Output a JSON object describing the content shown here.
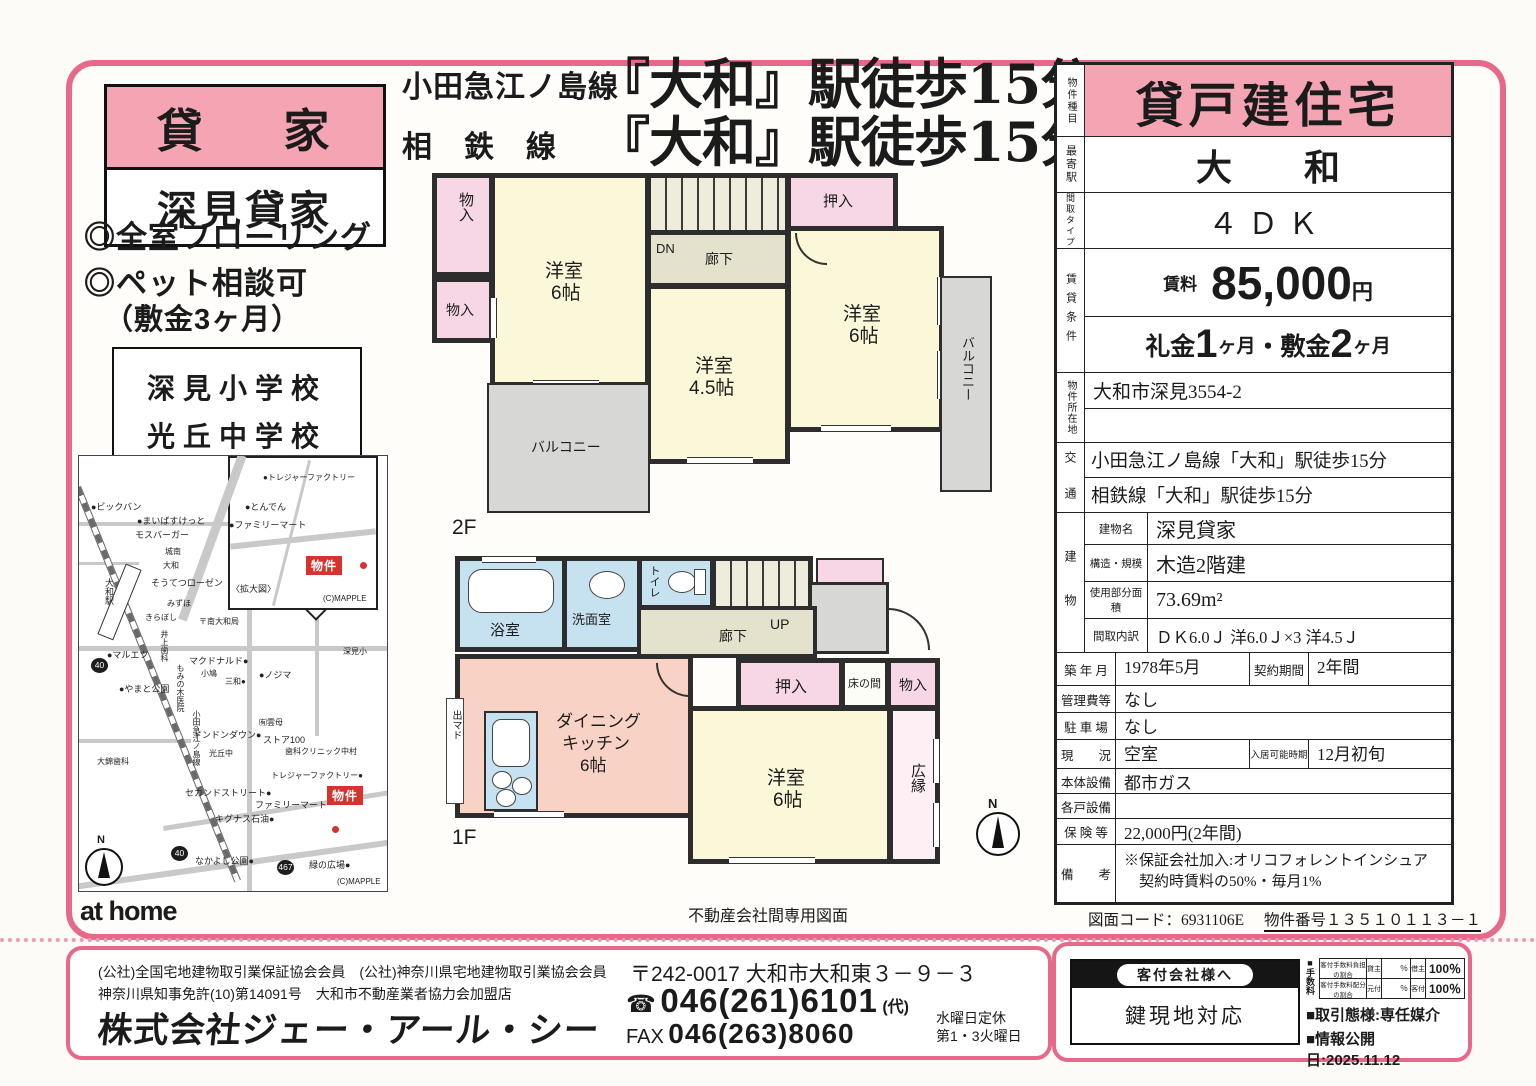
{
  "colors": {
    "frame_pink": "#e8688a",
    "fill_pink": "#f4a4b2",
    "marker_red": "#d8322f"
  },
  "title_box": {
    "header": "貸 家",
    "name": "深見貸家"
  },
  "features": [
    "◎全室フローリング",
    "◎ペット相談可",
    "（敷金3ヶ月）"
  ],
  "schools": [
    "深見小学校",
    "光丘中学校"
  ],
  "headline": {
    "line1_prefix": "小田急江ノ島線",
    "line1_main": "『大和』駅徒歩15分",
    "line2_prefix": "相　鉄　線",
    "line2_main": "『大和』駅徒歩15分"
  },
  "map": {
    "title": "〈現地案内図〉",
    "inset_title_note": "inset title is in labels",
    "credit": "(C)MAPPLE",
    "property_label": "物件",
    "compass_label": "N",
    "labels": [
      {
        "t": "●ビックバン",
        "x": 12,
        "y": 44
      },
      {
        "t": "●まいばすけっと",
        "x": 58,
        "y": 58
      },
      {
        "t": "モスバーガー",
        "x": 56,
        "y": 72
      },
      {
        "t": "城南",
        "x": 86,
        "y": 90,
        "s": 1
      },
      {
        "t": "大和",
        "x": 84,
        "y": 104,
        "s": 1
      },
      {
        "t": "そうてつローゼン",
        "x": 72,
        "y": 120
      },
      {
        "t": "みずほ",
        "x": 88,
        "y": 142,
        "s": 1
      },
      {
        "t": "きらぼし",
        "x": 66,
        "y": 156,
        "s": 1
      },
      {
        "t": "〒南大和局",
        "x": 120,
        "y": 160,
        "s": 1
      },
      {
        "t": "大和駅",
        "x": 24,
        "y": 122,
        "v": 1
      },
      {
        "t": "●マルエツ",
        "x": 28,
        "y": 192
      },
      {
        "t": "井上歯科",
        "x": 80,
        "y": 174,
        "v": 1,
        "s": 1
      },
      {
        "t": "マクドナルド●",
        "x": 110,
        "y": 198
      },
      {
        "t": "小鳩",
        "x": 122,
        "y": 212,
        "s": 1
      },
      {
        "t": "三和●",
        "x": 146,
        "y": 220,
        "s": 1
      },
      {
        "t": "●ノジマ",
        "x": 180,
        "y": 212
      },
      {
        "t": "深見小",
        "x": 264,
        "y": 190,
        "s": 1
      },
      {
        "t": "●やまと公園",
        "x": 40,
        "y": 226
      },
      {
        "t": "もみの木医院",
        "x": 96,
        "y": 208,
        "v": 1,
        "s": 1
      },
      {
        "t": "小田急江ノ島線",
        "x": 112,
        "y": 254,
        "v": 1,
        "s": 1
      },
      {
        "t": "ドンドンダウン●",
        "x": 114,
        "y": 272
      },
      {
        "t": "㈲雲母",
        "x": 180,
        "y": 261,
        "s": 1
      },
      {
        "t": "ストア100",
        "x": 184,
        "y": 277
      },
      {
        "t": "光丘中",
        "x": 130,
        "y": 292,
        "s": 1
      },
      {
        "t": "歯科クリニック中村",
        "x": 206,
        "y": 290,
        "s": 1
      },
      {
        "t": "大錦歯科",
        "x": 18,
        "y": 300,
        "s": 1
      },
      {
        "t": "トレジャーファクトリー●",
        "x": 192,
        "y": 314,
        "s": 1
      },
      {
        "t": "セカンドストリート●",
        "x": 106,
        "y": 330
      },
      {
        "t": "ファミリーマート",
        "x": 176,
        "y": 342
      },
      {
        "t": "キグナス石油●",
        "x": 136,
        "y": 356
      },
      {
        "t": "なかよし公園●",
        "x": 116,
        "y": 398
      },
      {
        "t": "緑の広場●",
        "x": 230,
        "y": 402
      },
      {
        "t": "40",
        "x": 12,
        "y": 202,
        "b": 1
      },
      {
        "t": "40",
        "x": 92,
        "y": 390,
        "b": 1
      },
      {
        "t": "467",
        "x": 198,
        "y": 404,
        "b": 1
      },
      {
        "t": "(C)MAPPLE",
        "x": 258,
        "y": 421,
        "s": 1
      },
      {
        "t": "●トレジャーファクトリー",
        "x": 184,
        "y": 16,
        "s": 1
      },
      {
        "t": "●とんでん",
        "x": 166,
        "y": 44
      },
      {
        "t": "●ファミリーマート",
        "x": 150,
        "y": 62
      },
      {
        "t": "〈拡大図〉",
        "x": 152,
        "y": 126
      },
      {
        "t": "(C)MAPPLE",
        "x": 244,
        "y": 138,
        "s": 1
      }
    ]
  },
  "plan2f": {
    "floor_label": "2F",
    "closet1": "物入",
    "closet2": "物入",
    "room_a": "洋室",
    "room_a_size": "6帖",
    "dn": "DN",
    "hall": "廊下",
    "oshiire": "押入",
    "room_b": "洋室",
    "room_b_size": "6帖",
    "room_c": "洋室",
    "room_c_size": "4.5帖",
    "balcony_bottom": "バルコニー",
    "balcony_right": "バルコニー"
  },
  "plan1f": {
    "floor_label": "1F",
    "bath": "浴室",
    "wash": "洗面室",
    "toilet": "トイレ",
    "up": "UP",
    "hall": "廊下",
    "demado": "出マド",
    "dk1": "ダイニング",
    "dk2": "キッチン",
    "dk3": "6帖",
    "oshiire": "押入",
    "tokonoma": "床の間",
    "monoire": "物入",
    "room": "洋室",
    "room_size": "6帖",
    "hiroen": "広縁"
  },
  "compass_label": "N",
  "table": {
    "property_type_label": "物件種目",
    "property_type": "貸戸建住宅",
    "station_label": "最寄駅",
    "station": "大　　和",
    "layout_label": "間取タイプ",
    "layout": "４ＤＫ",
    "terms_label": "賃貸条件",
    "rent_label": "賃料",
    "rent": "85,000",
    "rent_unit": "円",
    "fee1": "礼金",
    "fee1_num": "1",
    "fee1_unit": "ヶ月",
    "fee2": "・敷金",
    "fee2_num": "2",
    "fee2_unit": "ヶ月",
    "address_label": "物件所在地",
    "address": "大和市深見3554-2",
    "address2": "",
    "access_label": "交　通",
    "access1": "小田急江ノ島線「大和」駅徒歩15分",
    "access2": "相鉄線「大和」駅徒歩15分",
    "building_label": "建　物",
    "bname_label": "建物名",
    "bname": "深見貸家",
    "structure_label": "構造・規模",
    "structure": "木造2階建",
    "area_label": "使用部分面積",
    "area": "73.69m²",
    "madori_label": "間取内訳",
    "madori": "ＤＫ6.0Ｊ 洋6.0Ｊ×3 洋4.5Ｊ",
    "built_label": "築 年 月",
    "built": "1978年5月",
    "contract_label": "契約期間",
    "contract": "2年間",
    "mgmt_label": "管理費等",
    "mgmt": "なし",
    "parking_label": "駐 車 場",
    "parking": "なし",
    "status_label": "現　　況",
    "status": "空室",
    "movein_label": "入居可能時期",
    "movein": "12月初旬",
    "equip_label": "本体設備",
    "equip": "都市ガス",
    "unit_equip_label": "各戸設備",
    "unit_equip": "",
    "insurance_label": "保 険 等",
    "insurance": "22,000円(2年間)",
    "notes_label": "備　　考",
    "notes1": "※保証会社加入:オリコフォレントインシュア",
    "notes2": "　契約時賃料の50%・毎月1%"
  },
  "codes": {
    "zumen": "図面コード：6931106E",
    "bukken": "物件番号１３５１０１１３－１"
  },
  "footer": {
    "athome": "at home",
    "note": "不動産会社間専用図面"
  },
  "company": {
    "memberships1": "(公社)全国宅地建物取引業保証協会会員　(公社)神奈川県宅地建物取引業協会会員",
    "memberships2": "神奈川県知事免許(10)第14091号　大和市不動産業者協力会加盟店",
    "name": "株式会社ジェー・アール・シー",
    "postal": "〒242-0017 大和市大和東３－９－３",
    "tel_icon": "☎",
    "tel": "046(261)6101",
    "tel_suffix": "(代)",
    "fax_label": "FAX",
    "fax": "046(263)8060",
    "closed1": "水曜日定休",
    "closed2": "第1・3火曜日"
  },
  "agent_box": {
    "header": "客付会社様へ",
    "body": "鍵現地対応"
  },
  "fees": {
    "label": "■手数料",
    "row1_name": "客付手数料負担の割合",
    "row1_p1": "貸主",
    "row1_v1": "％",
    "row1_p2": "借主",
    "row1_v2": "100％",
    "row2_name": "客付手数料配分の割合",
    "row2_p1": "元付",
    "row2_v1": "％",
    "row2_p2": "客付",
    "row2_v2": "100％"
  },
  "deal": {
    "type": "■取引態様:専任媒介",
    "published": "■情報公開日:2025.11.12"
  }
}
